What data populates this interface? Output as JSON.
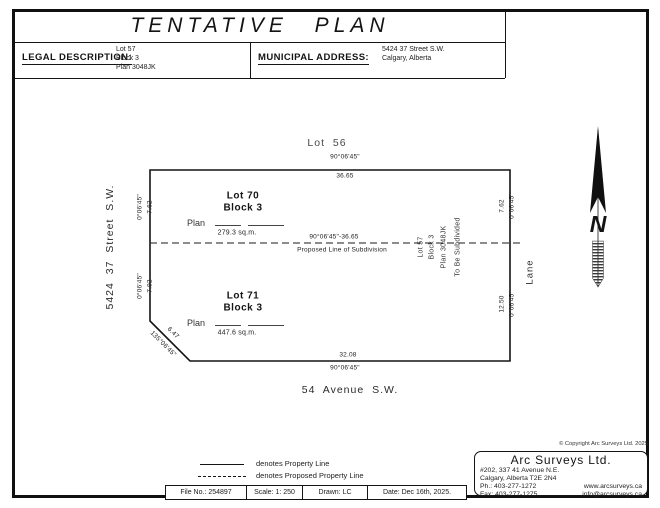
{
  "title": "TENTATIVE PLAN",
  "header": {
    "legal_label": "LEGAL DESCRIPTION:",
    "legal": [
      "Lot 57",
      "Block 3",
      "Plan 3048JK"
    ],
    "municipal_label": "MUNICIPAL ADDRESS:",
    "municipal": [
      "5424 37 Street S.W.",
      "Calgary, Alberta"
    ]
  },
  "plan": {
    "adjacent_lot": "Lot 56",
    "street_side": "5424 37 Street S.W.",
    "street_bottom": "54 Avenue S.W.",
    "lane": "Lane",
    "north": "N",
    "lot70": {
      "name": "Lot 70",
      "block": "Block 3",
      "plan_label": "Plan",
      "area": "279.3 sq.m."
    },
    "lot71": {
      "name": "Lot 71",
      "block": "Block 3",
      "plan_label": "Plan",
      "area": "447.6 sq.m."
    },
    "remainder": [
      "Lot 57",
      "Block 3",
      "Plan 3048JK",
      "To Be Subdivided"
    ],
    "subdiv": {
      "dim": "90°06'45\"-36.65",
      "label": "Proposed Line of Subdivision"
    },
    "dims": {
      "top_bearing": "90°06'45\"",
      "top_dist": "36.65",
      "left_top_bearing": "0°06'45\"",
      "left_top_dist": "7.62",
      "left_bot_bearing": "0°06'45\"",
      "left_bot_dist": "7.92",
      "right_top_dist": "7.62",
      "right_top_bearing": "0°06'45\"",
      "right_bot_dist": "12.50",
      "right_bot_bearing": "0°06'45\"",
      "diag_dist": "6.47",
      "diag_bearing": "135°06'45\"",
      "bottom_dist": "32.08",
      "bottom_bearing": "90°06'45\""
    }
  },
  "legend": {
    "solid_label": "denotes Property Line",
    "dashed_label": "denotes Proposed Property Line"
  },
  "infobar": {
    "file": "File No.: 254897",
    "scale": "Scale: 1: 250",
    "drawn": "Drawn:  LC",
    "date": "Date: Dec 16th, 2025."
  },
  "firm": {
    "copyright": "© Copyright Arc Surveys Ltd. 2025",
    "name": "Arc Surveys Ltd.",
    "addr1": "#202, 337 41 Avenue N.E.",
    "addr2": "Calgary, Alberta T2E 2N4",
    "phone": "Ph.: 403-277-1272",
    "fax": "Fax: 403-277-1275",
    "web": "www.arcsurveys.ca",
    "email": "info@arcsurveys.ca"
  }
}
